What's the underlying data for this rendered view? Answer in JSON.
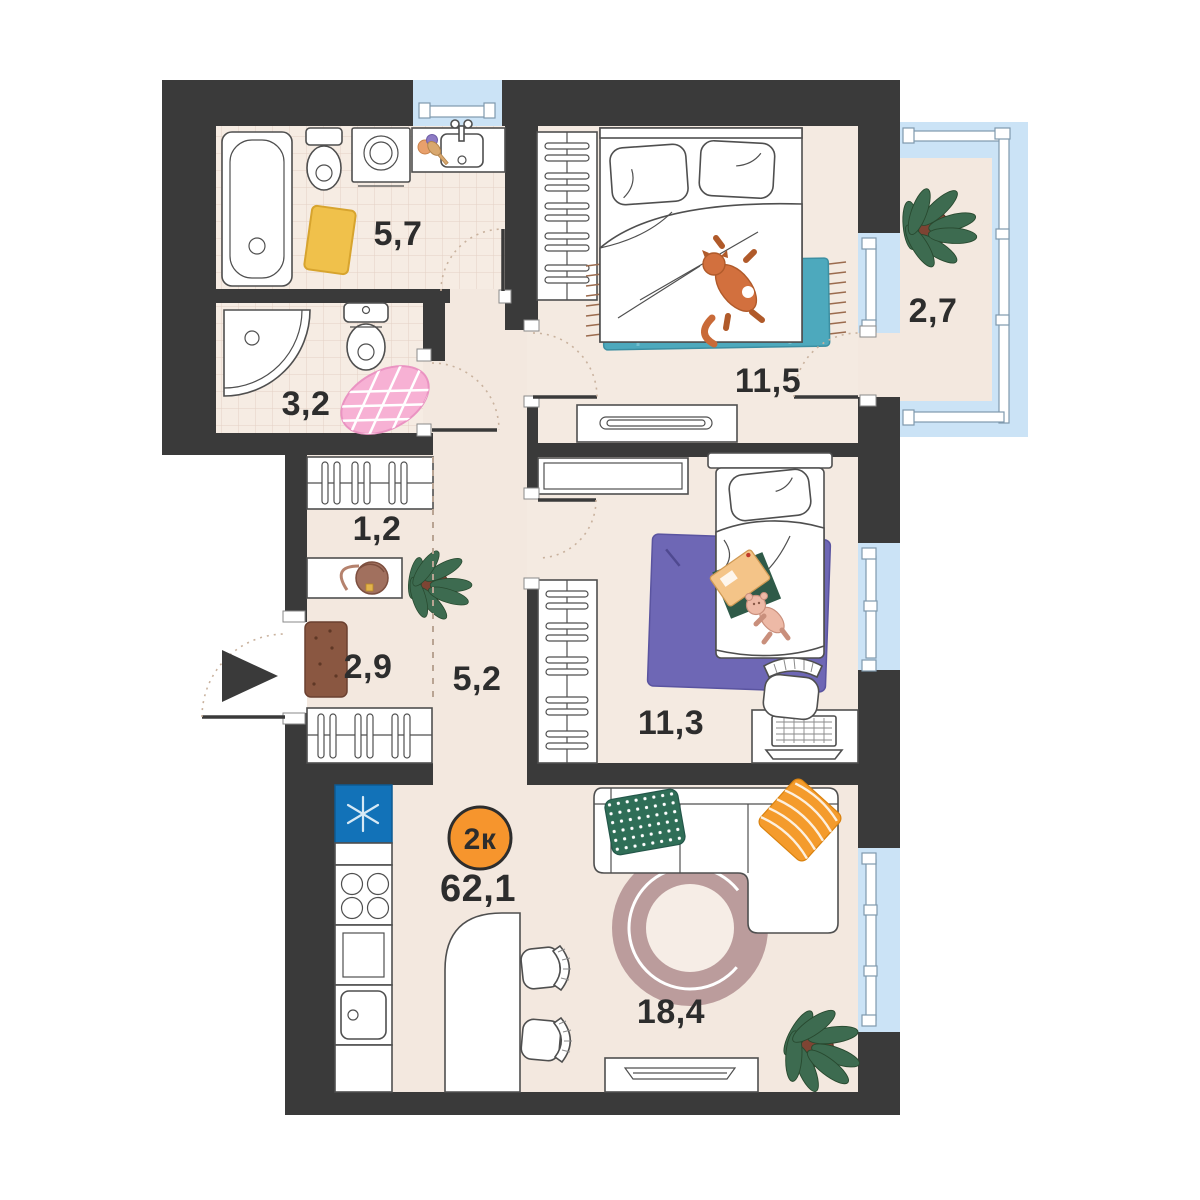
{
  "title": "2-room apartment floor plan",
  "badge": {
    "label": "2к",
    "color": "#f6952d"
  },
  "total_area": "62,1",
  "rooms": [
    {
      "name": "bathroom",
      "area": "5,7"
    },
    {
      "name": "wc",
      "area": "3,2"
    },
    {
      "name": "storage",
      "area": "1,2"
    },
    {
      "name": "hallway",
      "area": "2,9"
    },
    {
      "name": "corridor",
      "area": "5,2"
    },
    {
      "name": "bedroom",
      "area": "11,5"
    },
    {
      "name": "balcony",
      "area": "2,7"
    },
    {
      "name": "kids-room",
      "area": "11,3"
    },
    {
      "name": "living-kitchen",
      "area": "18,4"
    }
  ],
  "colors": {
    "wall": "#3a3a3a",
    "floor": "#f3e8df",
    "tile_floor": "#f6ece3",
    "window_glass": "#cbe3f6",
    "badge_orange": "#f6952d",
    "fridge_blue": "#1272b8",
    "teal_rug": "#4da9bd",
    "purple_rug": "#6e67b5",
    "pink_rug": "#f7b1d4",
    "round_rug": "#bb9c9c",
    "yellow_mat": "#f0c14b",
    "doormat_brown": "#8a5741",
    "green_pillow": "#2f6e57",
    "orange_pillow": "#f49b2c",
    "plant_green": "#3d6b50",
    "cat_orange": "#d2703e"
  }
}
